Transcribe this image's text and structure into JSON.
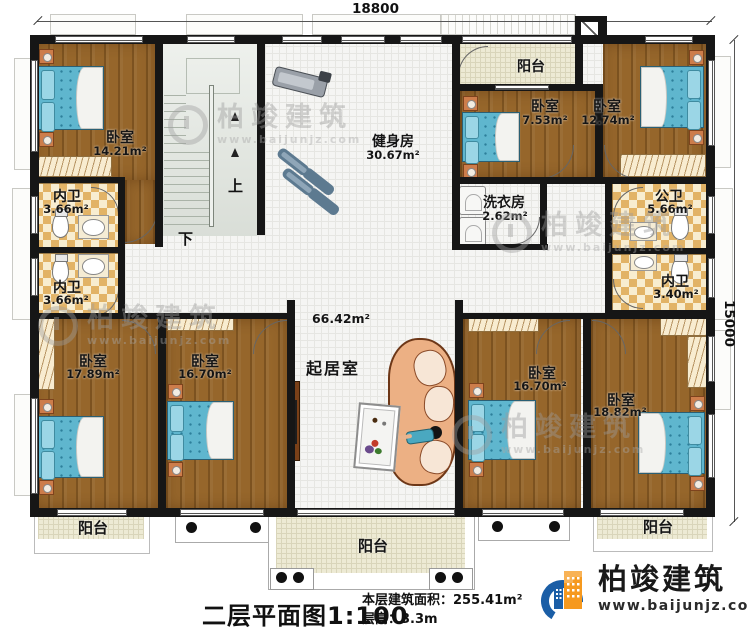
{
  "dimensions": {
    "top": "18800",
    "right": "15000"
  },
  "stairs": {
    "up": "上",
    "down": "下"
  },
  "rooms": {
    "bedroom_tl": {
      "name": "卧室",
      "area": "14.21m²"
    },
    "gym": {
      "name": "健身房",
      "area": "30.67m²"
    },
    "balcony_top": {
      "name": "阳台"
    },
    "bedroom_t2": {
      "name": "卧室",
      "area": "7.53m²"
    },
    "bedroom_t3": {
      "name": "卧室",
      "area": "12.74m²"
    },
    "laundry": {
      "name": "洗衣房",
      "area": "2.62m²"
    },
    "public_bath": {
      "name": "公卫",
      "area": "5.66m²"
    },
    "ensuite_right": {
      "name": "内卫",
      "area": "3.40m²"
    },
    "ensuite_left1": {
      "name": "内卫",
      "area": "3.66m²"
    },
    "ensuite_left2": {
      "name": "内卫",
      "area": "3.66m²"
    },
    "bedroom_bl": {
      "name": "卧室",
      "area": "17.89m²"
    },
    "bedroom_b2": {
      "name": "卧室",
      "area": "16.70m²"
    },
    "living": {
      "name": "起居室",
      "area": "66.42m²"
    },
    "bedroom_b3": {
      "name": "卧室",
      "area": "16.70m²"
    },
    "bedroom_br": {
      "name": "卧室",
      "area": "18.82m²"
    },
    "balcony_bl": {
      "name": "阳台"
    },
    "balcony_bc": {
      "name": "阳台"
    },
    "balcony_br": {
      "name": "阳台"
    }
  },
  "title_block": {
    "plan_title": "二层平面图",
    "scale": "1:100",
    "area_label": "本层建筑面积：",
    "area_value": "255.41m²",
    "height_label": "层高：",
    "height_value": "3.3m"
  },
  "branding": {
    "company": "柏竣建筑",
    "website": "www.baijunjz.com"
  },
  "watermark": {
    "company": "柏竣建筑",
    "website": "www.baijunjz.com"
  },
  "colors": {
    "wall": "#161616",
    "wood_floor": "#96662b",
    "bed": "#5fb6ce",
    "logo_blue": "#1b5ea6",
    "logo_orange": "#f6991e"
  }
}
